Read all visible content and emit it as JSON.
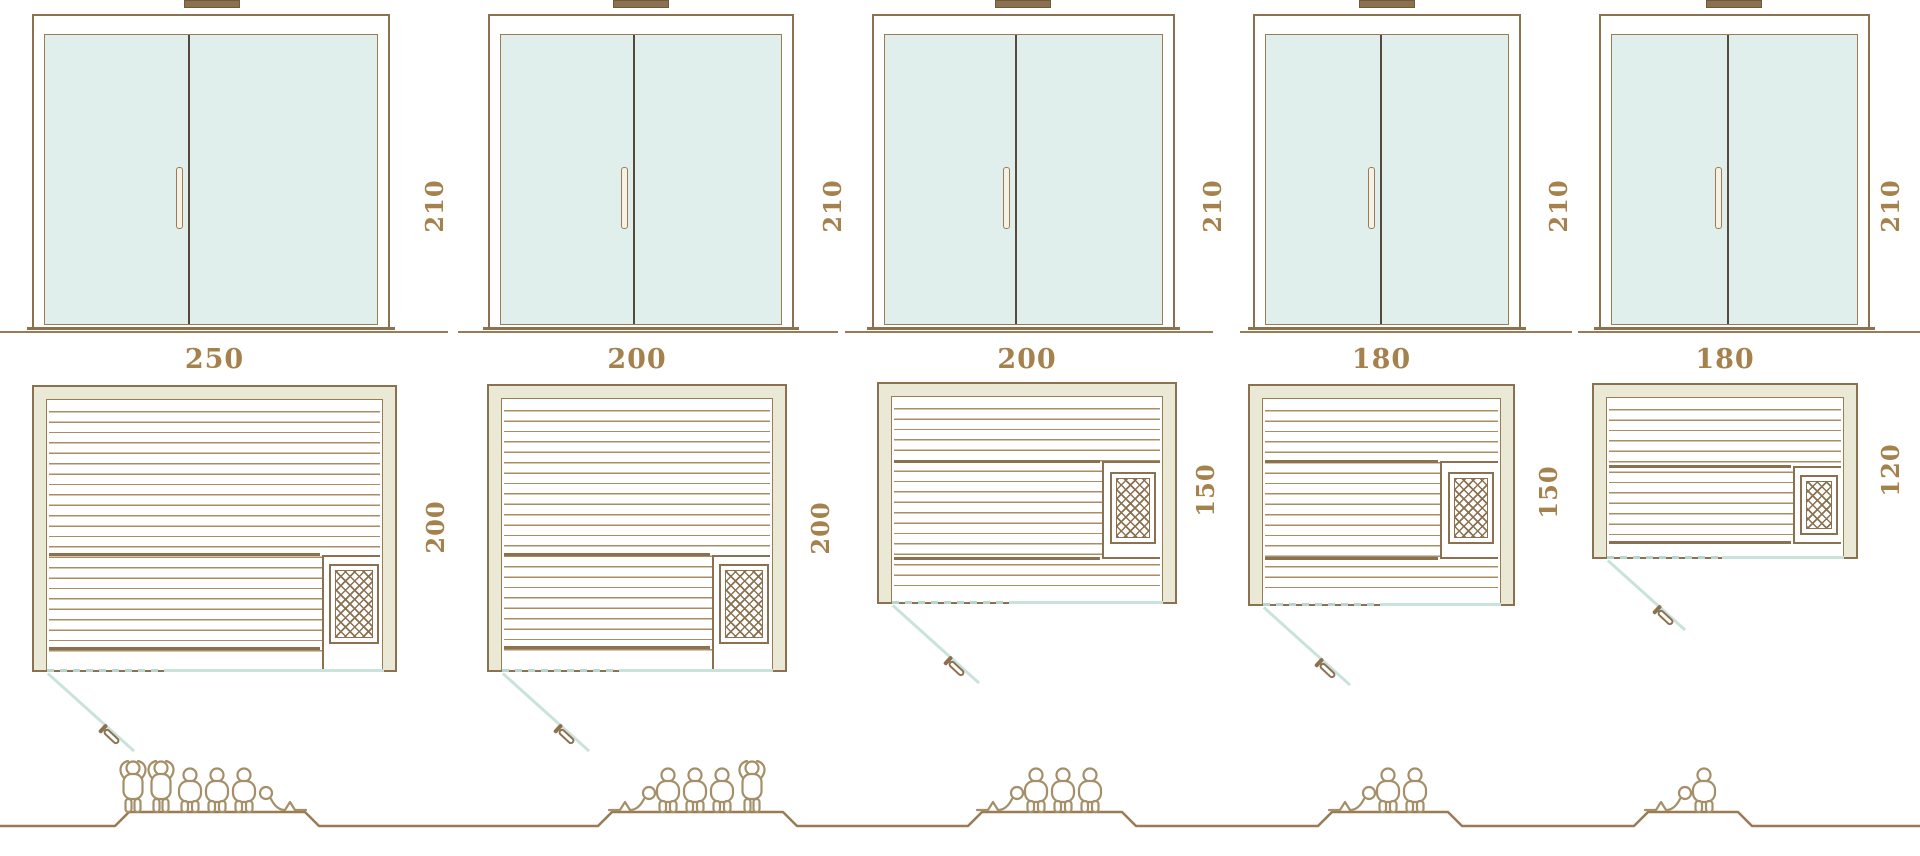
{
  "diagram_type": "sauna-size-comparison",
  "colors": {
    "line": "#8c7150",
    "label": "#a5824d",
    "glass": "#e0efeb",
    "wall_fill": "#eae9d6",
    "slat": "#aa8d63",
    "door_glass_line": "#c9e2dc",
    "figure_outline": "#a48f68"
  },
  "saunas": [
    {
      "front_height": "210",
      "plan_width": "250",
      "plan_depth": "200",
      "capacity": 6,
      "figures": [
        "standing",
        "standing",
        "seated",
        "seated",
        "seated",
        "reclining"
      ]
    },
    {
      "front_height": "210",
      "plan_width": "200",
      "plan_depth": "200",
      "capacity": 5,
      "figures": [
        "reclining",
        "seated",
        "seated",
        "seated",
        "standing"
      ]
    },
    {
      "front_height": "210",
      "plan_width": "200",
      "plan_depth": "150",
      "capacity": 4,
      "figures": [
        "reclining",
        "seated",
        "seated",
        "seated"
      ]
    },
    {
      "front_height": "210",
      "plan_width": "180",
      "plan_depth": "150",
      "capacity": 3,
      "figures": [
        "reclining",
        "seated",
        "seated"
      ]
    },
    {
      "front_height": "210",
      "plan_width": "180",
      "plan_depth": "120",
      "capacity": 2,
      "figures": [
        "reclining",
        "seated"
      ]
    }
  ]
}
